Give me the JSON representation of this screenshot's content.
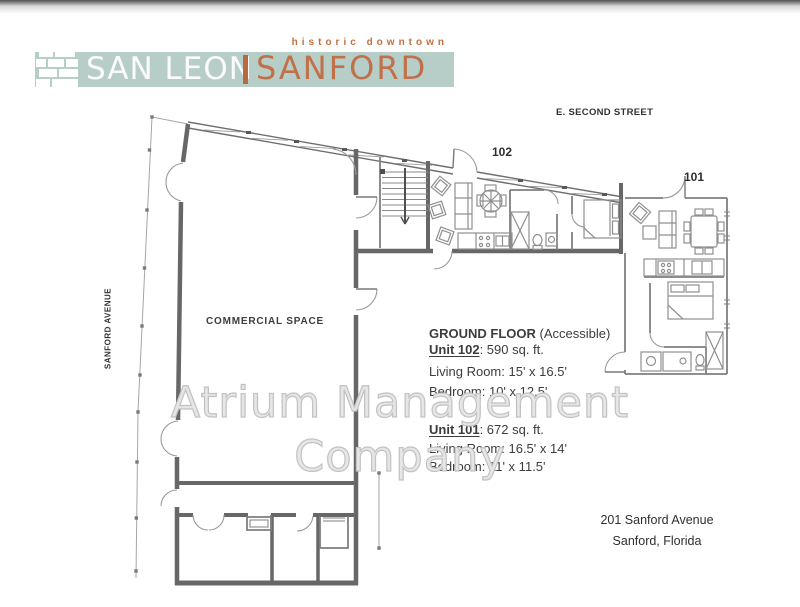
{
  "brand": {
    "tagline": "historic downtown",
    "name_left": "SAN LEON",
    "name_right": "SANFORD",
    "icon": "brick-pattern-icon",
    "colors": {
      "bar_teal": "#b7cec8",
      "orange": "#c0714a",
      "divider_orange": "#b9693f",
      "name_white": "#fafbfa"
    }
  },
  "plan": {
    "street_label": "E. SECOND STREET",
    "avenue_label": "SANFORD AVENUE",
    "commercial_label": "COMMERCIAL SPACE",
    "unit_labels": {
      "upper": "102",
      "right": "101"
    }
  },
  "info": {
    "title": "GROUND FLOOR",
    "subtitle": "(Accessible)",
    "units": [
      {
        "name": "Unit 102",
        "area": ":  590 sq. ft.",
        "lines": [
          "Living Room: 15' x 16.5'",
          "Bedroom: 10' x 12.5'"
        ]
      },
      {
        "name": "Unit 101",
        "area": ":  672 sq. ft.",
        "lines": [
          "Living Room: 16.5' x 14'",
          "Bedroom: 11' x 11.5'"
        ]
      }
    ]
  },
  "address": {
    "line1": "201 Sanford Avenue",
    "line2": "Sanford, Florida"
  },
  "watermark": {
    "line1": "Atrium Management",
    "line2": "Company"
  }
}
